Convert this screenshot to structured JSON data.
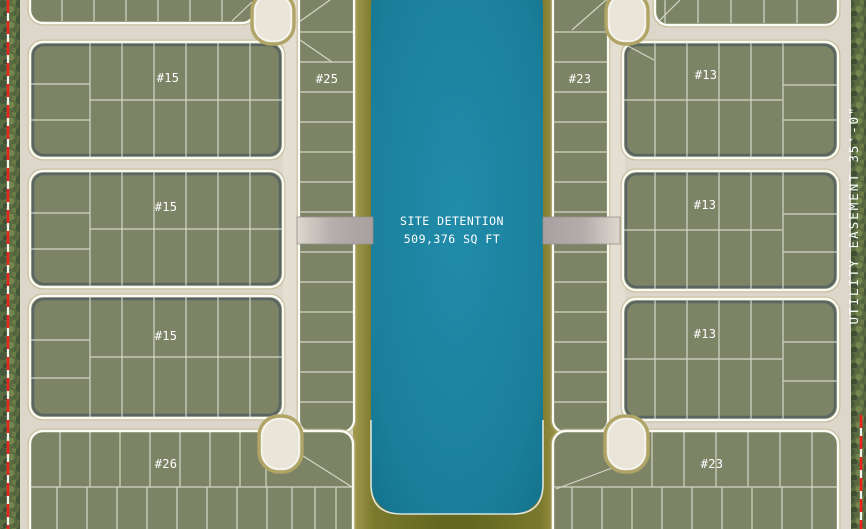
{
  "labels": {
    "block_15_1": "#15",
    "block_15_2": "#15",
    "block_15_3": "#15",
    "block_26": "#26",
    "strip_25": "#25",
    "strip_23_top": "#23",
    "block_13_1": "#13",
    "block_13_2": "#13",
    "block_13_3": "#13",
    "block_23_bottom": "#23",
    "detention_line1": "SITE DETENTION",
    "detention_line2": "509,376 SQ FT",
    "utility_easement": "UTILITY EASEMENT 35'-0\""
  },
  "colors": {
    "water_teal": "#1e87a3",
    "berm_olive": "#6f7026",
    "lot_green": "#7d8466",
    "road_beige": "#dcd7ca",
    "boundary_red": "#ea231a",
    "lot_line_white": "#e9ebdf",
    "block_rim_slate": "#4e5b61",
    "curb_tan": "#b7ab74",
    "vegetation_green": "#5a6b41",
    "access_stub_gray": "#b2aaa8",
    "label_white": "#ffffff"
  }
}
